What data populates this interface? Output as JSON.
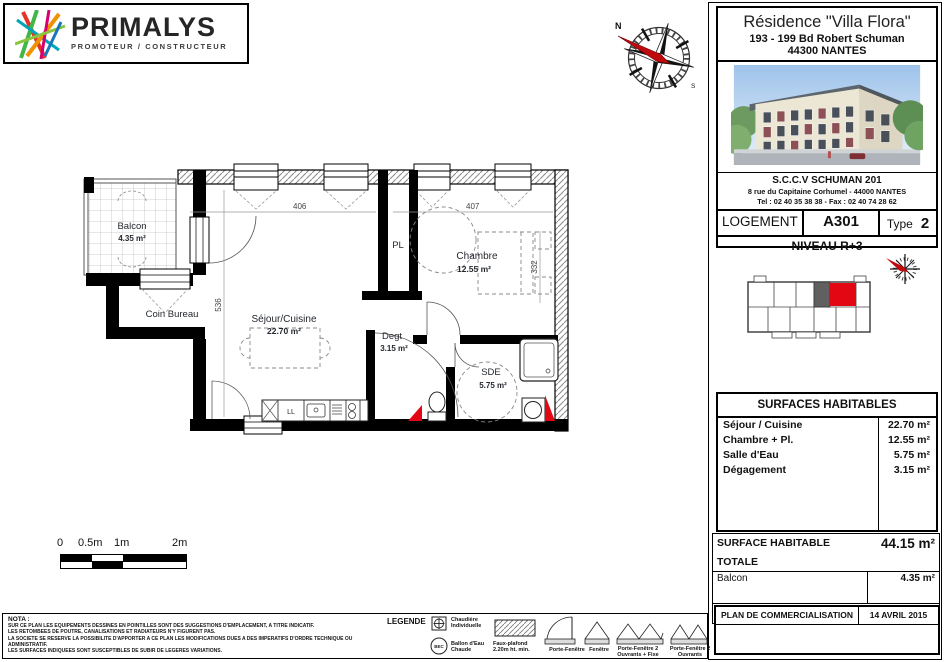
{
  "logo": {
    "name": "PRIMALYS",
    "tagline": "PROMOTEUR / CONSTRUCTEUR"
  },
  "project": {
    "title": "Résidence \"Villa Flora\"",
    "address1": "193 - 199 Bd Robert Schuman",
    "address2": "44300 NANTES"
  },
  "developer": {
    "name": "S.C.C.V SCHUMAN 201",
    "address": "8 rue du Capitaine Corhumel - 44000 NANTES",
    "phone_fax": "Tel : 02 40 35 38 38 - Fax : 02 40 74 28 62"
  },
  "unit": {
    "logement_label": "LOGEMENT",
    "number": "A301",
    "type_label": "Type",
    "type_value": "2",
    "level": "NIVEAU R+3"
  },
  "plan": {
    "rooms": [
      {
        "name": "Balcon",
        "area": "4.35 m²"
      },
      {
        "name": "Coin Bureau",
        "area": ""
      },
      {
        "name": "Séjour/Cuisine",
        "area": "22.70 m²"
      },
      {
        "name": "PL",
        "area": ""
      },
      {
        "name": "Chambre",
        "area": "12.55 m²"
      },
      {
        "name": "Degt",
        "area": "3.15 m²"
      },
      {
        "name": "SDE",
        "area": "5.75 m²"
      }
    ],
    "appliance_label": "LL",
    "dims": {
      "d1": "406",
      "d2": "407",
      "d3": "536",
      "d4": "332"
    },
    "compass_north": "N",
    "compass_south": "S"
  },
  "scale_bar": {
    "t0": "0",
    "t05": "0.5m",
    "t1": "1m",
    "t2": "2m"
  },
  "surfaces": {
    "title": "SURFACES HABITABLES",
    "rows": [
      {
        "label": "Séjour / Cuisine",
        "value": "22.70 m²"
      },
      {
        "label": "Chambre + Pl.",
        "value": "12.55 m²"
      },
      {
        "label": "Salle d'Eau",
        "value": "5.75 m²"
      },
      {
        "label": "Dégagement",
        "value": "3.15 m²"
      }
    ]
  },
  "totals": {
    "total_label": "SURFACE HABITABLE TOTALE",
    "total_value": "44.15 m²",
    "balcony_label": "Balcon",
    "balcony_value": "4.35 m²",
    "living_label": "SURFACE A VIVRE",
    "living_value": "48.50 m²"
  },
  "footer": {
    "plan_label": "PLAN DE COMMERCIALISATION",
    "date": "14 AVRIL 2015"
  },
  "nota": {
    "title": "NOTA :",
    "line1": "SUR CE PLAN LES EQUIPEMENTS DESSINES EN POINTILLES SONT DES SUGGESTIONS D'EMPLACEMENT, A TITRE INDICATIF.",
    "line2": "LES RETOMBEES DE POUTRE, CANALISATIONS ET RADIATEURS N'Y FIGURENT PAS.",
    "line3": "LA SOCIETE SE RESERVE LA POSSIBILITE D'APPORTER A CE PLAN LES MODIFICATIONS DUES A DES IMPERATIFS D'ORDRE TECHNIQUE OU ADMINISTRATIF.",
    "line4": "LES SURFACES INDIQUEES SONT SUSCEPTIBLES DE SUBIR DE LEGERES VARIATIONS."
  },
  "legend": {
    "title": "LEGENDE",
    "boiler": "Chaudière Individuelle",
    "bec_symbol": "BEC",
    "bec": "Ballon d'Eau Chaude",
    "ceiling": "Faux-plafond 2.20m ht. min.",
    "door_window": "Porte-Fenêtre",
    "window": "Fenêtre",
    "dw2f": "Porte-Fenêtre 2 Ouvrants + Fixe",
    "dw2": "Porte-Fenêtre 2 Ouvrants"
  },
  "colors": {
    "accent_red": "#e30613",
    "wall_black": "#000000"
  }
}
